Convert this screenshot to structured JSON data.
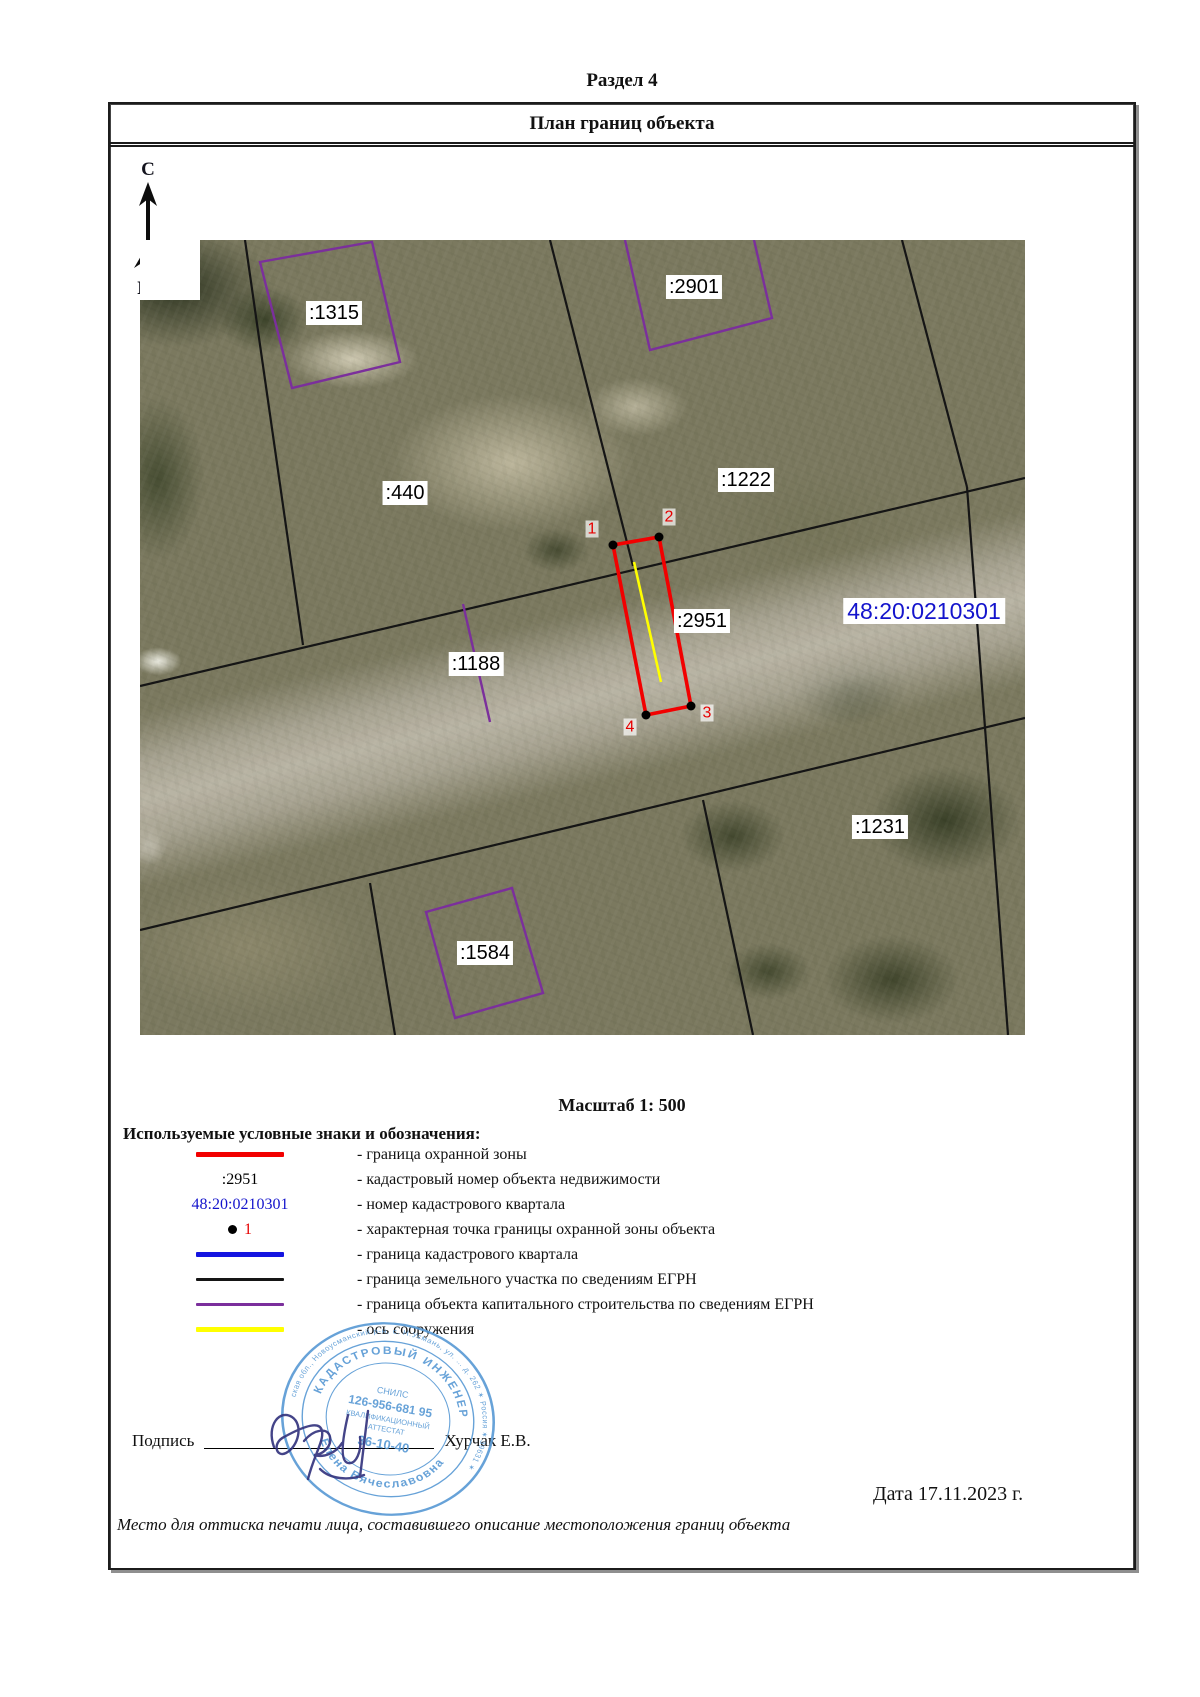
{
  "document": {
    "section_title": "Раздел 4",
    "plan_title": "План границ объекта",
    "scale_text": "Масштаб 1: 500",
    "legend_heading": "Используемые условные знаки и обозначения:",
    "signature_label": "Подпись",
    "signer_name": "Хурчак Е.В.",
    "date_text": "Дата 17.11.2023 г.",
    "footer_note": "Место для оттиска печати лица, составившего описание местоположения границ объекта"
  },
  "compass": {
    "north": "С",
    "south": "Ю"
  },
  "map": {
    "quarter_label": {
      "text": "48:20:0210301",
      "x": 784,
      "y": 371
    },
    "parcel_labels": [
      {
        "text": ":1315",
        "x": 194,
        "y": 73
      },
      {
        "text": ":2901",
        "x": 554,
        "y": 47
      },
      {
        "text": ":440",
        "x": 265,
        "y": 253
      },
      {
        "text": ":1222",
        "x": 606,
        "y": 240
      },
      {
        "text": ":1188",
        "x": 336,
        "y": 424
      },
      {
        "text": ":2951",
        "x": 562,
        "y": 381
      },
      {
        "text": ":1231",
        "x": 740,
        "y": 587
      },
      {
        "text": ":1584",
        "x": 345,
        "y": 713
      }
    ],
    "point_labels": [
      {
        "n": "1",
        "x": 452,
        "y": 289
      },
      {
        "n": "2",
        "x": 529,
        "y": 277
      },
      {
        "n": "3",
        "x": 567,
        "y": 473
      },
      {
        "n": "4",
        "x": 490,
        "y": 487
      }
    ],
    "geometry": {
      "black_lines": [
        [
          0,
          446,
          885,
          238
        ],
        [
          0,
          690,
          885,
          478
        ],
        [
          105,
          0,
          163,
          405
        ],
        [
          410,
          0,
          493,
          326
        ],
        [
          762,
          0,
          827,
          247
        ],
        [
          827,
          247,
          868,
          795
        ],
        [
          563,
          560,
          613,
          795
        ],
        [
          230,
          643,
          255,
          795
        ]
      ],
      "purple_polygons": [
        [
          [
            120,
            22
          ],
          [
            232,
            2
          ],
          [
            260,
            122
          ],
          [
            152,
            148
          ]
        ],
        [
          [
            286,
            672
          ],
          [
            372,
            648
          ],
          [
            403,
            753
          ],
          [
            315,
            778
          ]
        ]
      ],
      "purple_polylines": [
        [
          [
            485,
            0
          ],
          [
            510,
            110
          ],
          [
            632,
            78
          ],
          [
            614,
            0
          ]
        ]
      ],
      "purple_lines": [
        [
          323,
          364,
          350,
          482
        ]
      ],
      "red_zone": [
        [
          473,
          305
        ],
        [
          519,
          297
        ],
        [
          551,
          466
        ],
        [
          506,
          475
        ]
      ],
      "yellow_axis": [
        494,
        322,
        521,
        442
      ]
    }
  },
  "legend_items": [
    {
      "symbol": "line-red",
      "label": "- граница охранной зоны"
    },
    {
      "symbol": "text-black",
      "symbol_text": ":2951",
      "label": "- кадастровый номер объекта недвижимости"
    },
    {
      "symbol": "text-blue",
      "symbol_text": "48:20:0210301",
      "label": "- номер кадастрового квартала"
    },
    {
      "symbol": "point",
      "symbol_text": "1",
      "label": "- характерная точка границы охранной зоны объекта"
    },
    {
      "symbol": "line-blue",
      "label": "- граница кадастрового квартала"
    },
    {
      "symbol": "line-black",
      "label": "- граница земельного участка по сведениям ЕГРН"
    },
    {
      "symbol": "line-purple",
      "label": "- граница объекта капитального строительства по сведениям ЕГРН"
    },
    {
      "symbol": "line-yellow",
      "label": "- ось сооружения"
    }
  ],
  "stamp": {
    "ring_text": "ская обл., Новоусманский р-н, с. Н.Усмань, ул. … д. 262 ✶ Россия ✶ 39631 ✶",
    "title_arc": "КАДАСТРОВЫЙ ИНЖЕНЕР",
    "name_arc": "Елена Вячеславовна",
    "center_lines": [
      "СНИЛС",
      "126-956-681 95",
      "КВАЛИФИКАЦИОННЫЙ",
      "АТТЕСТАТ",
      "36-10-40"
    ]
  },
  "colors": {
    "zone_red": "#f20000",
    "kvartal_blue": "#1414e0",
    "egrn_black": "#151515",
    "oks_purple": "#7b2f9c",
    "axis_yellow": "#ffff00",
    "quarter_text": "#1414cc",
    "point_red": "#e60000",
    "stamp_blue": "#5b9bd5",
    "ink_blue": "#34347e"
  }
}
